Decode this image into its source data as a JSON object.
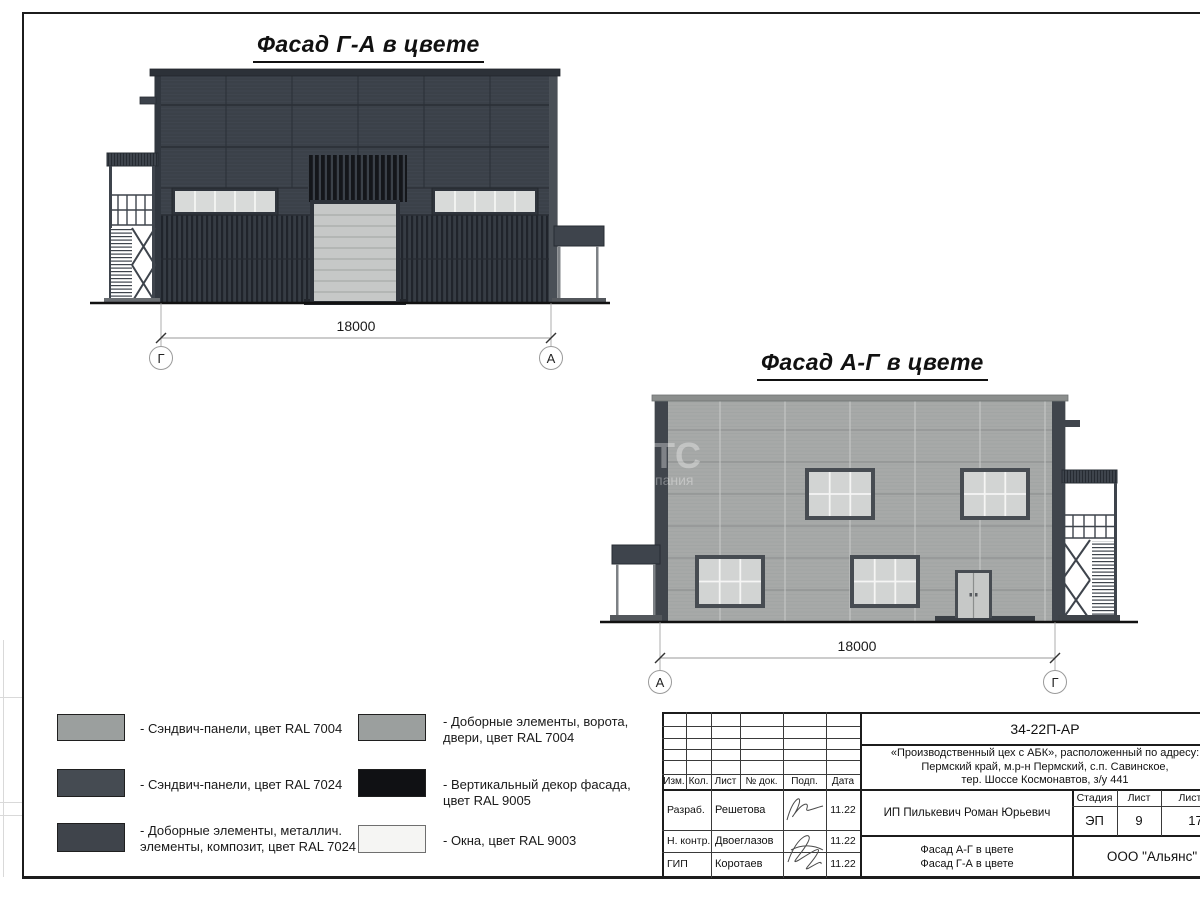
{
  "facades": [
    {
      "title": "Фасад Г-А в цвете",
      "dimension": "18000",
      "axis_left": "Г",
      "axis_right": "А"
    },
    {
      "title": "Фасад А-Г в цвете",
      "dimension": "18000",
      "axis_left": "А",
      "axis_right": "Г"
    }
  ],
  "legend": {
    "items": [
      {
        "color": "#9b9f9e",
        "label": "- Сэндвич-панели, цвет RAL 7004"
      },
      {
        "color": "#454b52",
        "label": "- Сэндвич-панели, цвет RAL 7024"
      },
      {
        "color": "#3f444b",
        "label": "- Доборные элементы, металлич.\nэлементы, композит, цвет RAL 7024"
      },
      {
        "color": "#9b9f9e",
        "label": "- Доборные элементы, ворота,\nдвери, цвет RAL 7004"
      },
      {
        "color": "#101114",
        "label": "- Вертикальный декор фасада,\nцвет RAL 9005"
      },
      {
        "color": "#f5f5f3",
        "label": "- Окна, цвет RAL 9003"
      }
    ]
  },
  "title_block": {
    "doc_code": "34-22П-АР",
    "project_address": "«Производственный цех с АБК», расположенный по адресу:\nПермский край, м.р-н Пермский, с.п. Савинское,\nтер. Шоссе Космонавтов, з/у 441",
    "columns": [
      "Изм.",
      "Кол.",
      "Лист",
      "№ док.",
      "Подп.",
      "Дата"
    ],
    "signoff_rows": [
      {
        "role": "Разраб.",
        "name": "Решетова",
        "date": "11.22"
      },
      {
        "role": "Н. контр.",
        "name": "Двоеглазов",
        "date": "11.22"
      },
      {
        "role": "ГИП",
        "name": "Коротаев",
        "date": "11.22"
      }
    ],
    "client": "ИП Пилькевич Роман Юрьевич",
    "stage_label": "Стадия",
    "sheet_label": "Лист",
    "sheets_label": "Листов",
    "stage": "ЭП",
    "sheet_number": "9",
    "sheets_total": "17",
    "drawing_titles": "Фасад А-Г в цвете\nФасад Г-А в цвете",
    "company": "ООО \"Альянс\""
  },
  "watermark": {
    "large": "ТС",
    "small": "пания"
  },
  "colors": {
    "facade_dark": "#3b4149",
    "facade_light": "#a7a9a8",
    "ral7004": "#9b9f9e",
    "ral7024": "#454b52",
    "ral7024_dark": "#3f444b",
    "ral9005": "#101114",
    "ral9003": "#f5f5f3"
  }
}
